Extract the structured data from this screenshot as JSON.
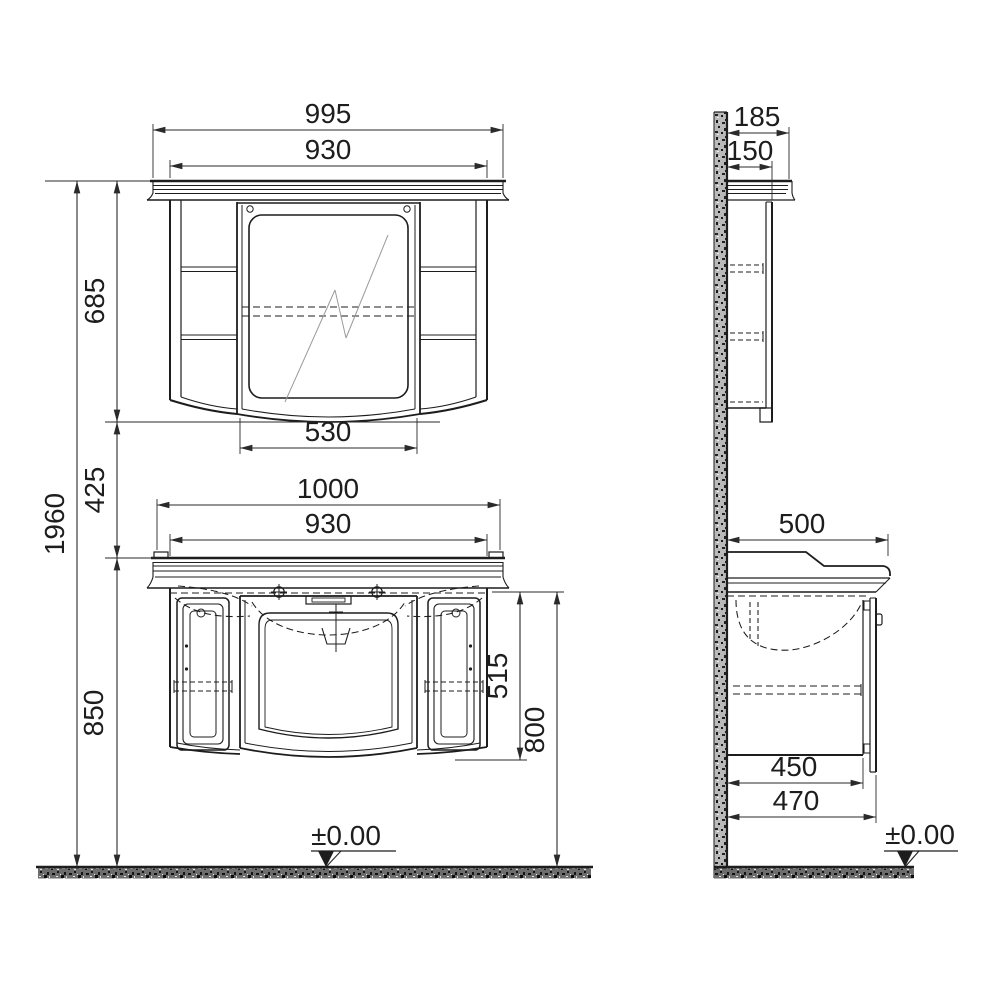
{
  "drawing": {
    "type": "technical-dimension-drawing",
    "subject": "bathroom vanity unit with mirror cabinet, front and side elevations",
    "units": "mm",
    "dimensions": {
      "mirror_cabinet_front": {
        "overall_width": "995",
        "body_width": "930",
        "body_height": "685",
        "mirror_door_width": "530"
      },
      "mirror_cabinet_side": {
        "overall_depth": "185",
        "body_depth": "150"
      },
      "vanity_front": {
        "countertop_width": "1000",
        "body_width": "930",
        "body_height": "515",
        "floor_to_body_top": "800"
      },
      "elevation_chain": {
        "overall_height": "1960",
        "gap_mirror_to_counter": "425",
        "floor_to_countertop": "850",
        "floor_level": "±0.00"
      },
      "vanity_side": {
        "countertop_depth": "500",
        "body_depth": "450",
        "door_depth": "470",
        "floor_level": "±0.00"
      }
    }
  }
}
